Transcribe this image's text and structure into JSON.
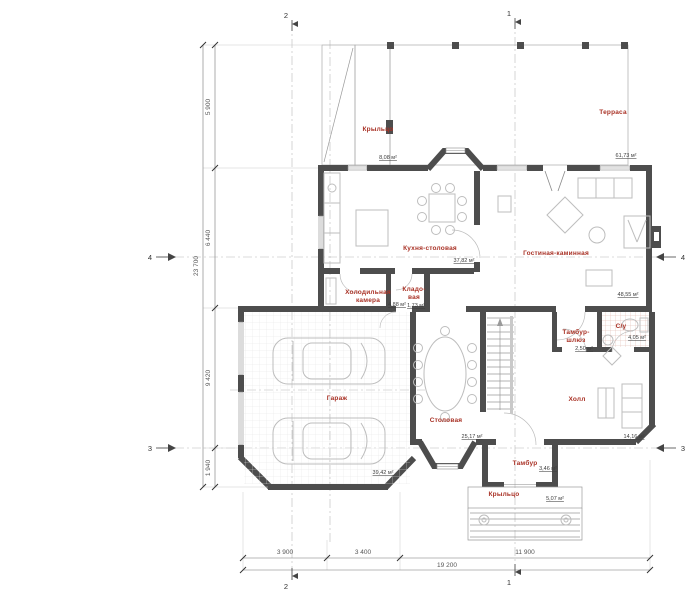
{
  "rooms": {
    "terrace": {
      "label": "Терраса",
      "area": "61,73 м²"
    },
    "porch_top": {
      "label": "Крыльцо",
      "area": "8,08 м²"
    },
    "kitchen": {
      "label": "Кухня-столовая",
      "area": "37,82 м²"
    },
    "living": {
      "label": "Гостиная-каминная",
      "area": "48,55 м²"
    },
    "cold_room": {
      "line1": "Холодильная",
      "line2": "камера",
      "area": "4,88 м²"
    },
    "pantry": {
      "line1": "Кладо-",
      "line2": "вая",
      "area": "1,73 м²"
    },
    "garage": {
      "label": "Гараж",
      "area": "39,42 м²"
    },
    "dining": {
      "label": "Столовая",
      "area": "25,17 м²"
    },
    "airlock": {
      "line1": "Тамбур-",
      "line2": "шлюз",
      "area": "2,50 м²"
    },
    "wc": {
      "label": "С/у",
      "area": "4,05 м²"
    },
    "hall": {
      "label": "Холл",
      "area": "14,16 м²"
    },
    "vestibule": {
      "label": "Тамбур",
      "area": "3,46 м²"
    },
    "porch_bottom": {
      "label": "Крыльцо",
      "area": "5,07 м²"
    }
  },
  "dimensions": {
    "left_segments": [
      "5 900",
      "6 440",
      "9 420",
      "1 940"
    ],
    "left_total": "23 700",
    "bottom_segments": [
      "3 900",
      "3 400",
      "11 900"
    ],
    "bottom_total": "19 200"
  },
  "markers": {
    "axis_1": "1",
    "axis_2": "2",
    "axis_3": "3",
    "axis_4": "4"
  },
  "colors": {
    "wall": "#4d4d4d",
    "room_label": "#a93226",
    "area_label": "#3c3c3c",
    "furniture": "#bdbdbd",
    "dimension": "#555555",
    "wc_tile": "#ddb0a6"
  }
}
